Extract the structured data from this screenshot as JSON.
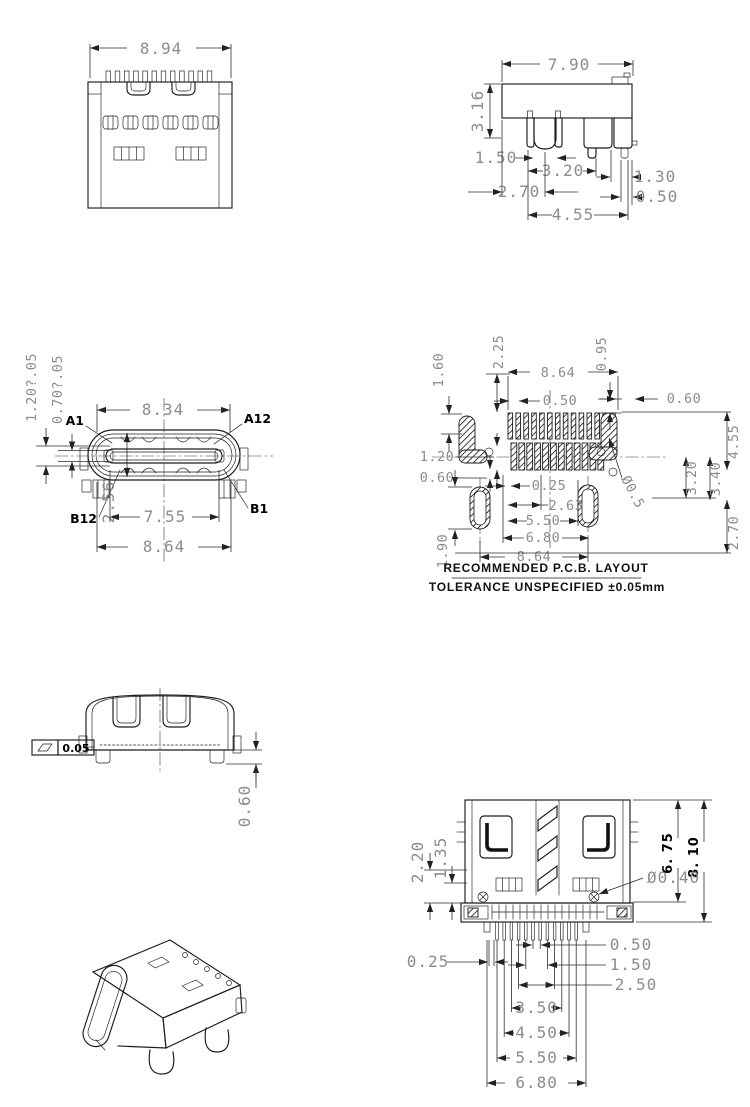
{
  "colors": {
    "background": "#ffffff",
    "line": "#1c1c1c",
    "dim_text": "#8c8c8c",
    "label_text": "#000000"
  },
  "notes": {
    "pcb_note1": "RECOMMENDED   P.C.B.  LAYOUT",
    "pcb_note2": "TOLERANCE  UNSPECIFIED  ±0.05mm"
  },
  "views": {
    "top": {
      "dim_width": "8.94"
    },
    "side": {
      "dim_width": "7.90",
      "dim_height": "3.16",
      "dim_leg": "1.50",
      "dim_span": "3.20",
      "dim_pin": "1.30",
      "dim_left": "2.70",
      "dim_right": "0.50",
      "dim_total": "4.55"
    },
    "front": {
      "pin_a1": "A1",
      "pin_a12": "A12",
      "pin_b12": "B12",
      "pin_b1": "B1",
      "dim_opening": "8.34",
      "dim_inner": "7.55",
      "dim_shell": "8.64",
      "dim_height": "2.56",
      "dim_tol_outer": "1.20?.05",
      "dim_tol_tongue": "0.70?.05"
    },
    "pcb": {
      "dim_2_25": "2.25",
      "dim_1_60": "1.60",
      "dim_row": "8.64",
      "dim_pitch": "0.50",
      "dim_0_95": "0.95",
      "dim_0_60_right": "0.60",
      "dim_1_20": "1.20",
      "dim_0_60_left": "0.60",
      "dim_0_25": "0.25",
      "dim_2_63": "2.63",
      "dim_5_50": "5.50",
      "dim_6_80": "6.80",
      "dim_span": "8.64",
      "dim_1_90": "1.90",
      "dim_3_20": "3.20",
      "dim_3_40": "3.40",
      "dim_4_55": "4.55",
      "dim_2_70": "2.70",
      "dim_hole": "Ø0.5"
    },
    "rear": {
      "flatness_value": "0.05",
      "flatness_symbol": "flatness-parallelogram",
      "dim_standoff": "0.60"
    },
    "bottom": {
      "dim_2_20": "2.20",
      "dim_1_35": "1.35",
      "dim_6_75": "6. 75",
      "dim_8_10": "8. 10",
      "dim_hole": "Ø0.40",
      "dim_0_25": "0.25",
      "dim_0_50": "0.50",
      "dim_1_50": "1.50",
      "dim_2_50": "2.50",
      "dim_3_50": "3.50",
      "dim_4_50": "4.50",
      "dim_5_50": "5.50",
      "dim_6_80": "6.80"
    }
  }
}
